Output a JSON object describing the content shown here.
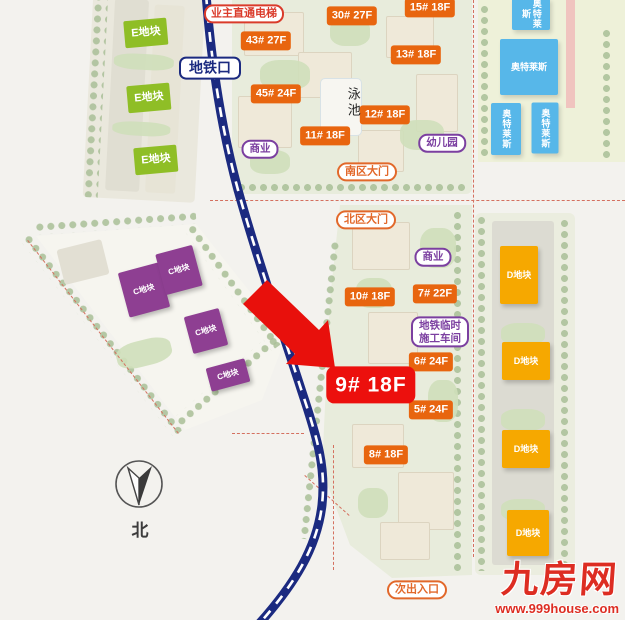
{
  "colors": {
    "building_label_orange": "#e8650f",
    "plot_e_green": "#8fbe26",
    "plot_c_purple": "#8e3f92",
    "plot_d_amber": "#f6a800",
    "commercial_blue": "#57b7e9",
    "highlight_red": "#ec100d",
    "metro_navy": "#1b2a80",
    "boundary_dash_red": "#d4705f",
    "watermark_red": "#dd2d22"
  },
  "watermark": {
    "brand": "九房网",
    "url": "www.999house.com"
  },
  "compass": {
    "label": "北"
  },
  "labels": [
    {
      "name": "building-label-15",
      "type": "t-orange",
      "text": "15# 18F",
      "x": 430,
      "y": 8
    },
    {
      "name": "building-label-30",
      "type": "t-orange",
      "text": "30# 27F",
      "x": 352,
      "y": 16
    },
    {
      "name": "building-label-43",
      "type": "t-orange",
      "text": "43# 27F",
      "x": 266,
      "y": 41
    },
    {
      "name": "building-label-13",
      "type": "t-orange",
      "text": "13# 18F",
      "x": 416,
      "y": 55
    },
    {
      "name": "building-label-45",
      "type": "t-orange",
      "text": "45# 24F",
      "x": 276,
      "y": 94
    },
    {
      "name": "building-label-12",
      "type": "t-orange",
      "text": "12# 18F",
      "x": 385,
      "y": 115
    },
    {
      "name": "building-label-11",
      "type": "t-orange",
      "text": "11# 18F",
      "x": 325,
      "y": 136
    },
    {
      "name": "building-label-10",
      "type": "t-orange",
      "text": "10# 18F",
      "x": 370,
      "y": 297
    },
    {
      "name": "building-label-7",
      "type": "t-orange",
      "text": "7# 22F",
      "x": 435,
      "y": 294
    },
    {
      "name": "building-label-6",
      "type": "t-orange",
      "text": "6# 24F",
      "x": 431,
      "y": 362
    },
    {
      "name": "building-label-5",
      "type": "t-orange",
      "text": "5# 24F",
      "x": 431,
      "y": 410
    },
    {
      "name": "building-label-8",
      "type": "t-orange",
      "text": "8# 18F",
      "x": 386,
      "y": 455
    },
    {
      "name": "plot-label-e-1",
      "type": "t-green",
      "text": "E地块",
      "x": 146,
      "y": 33,
      "rot": -5
    },
    {
      "name": "plot-label-e-2",
      "type": "t-green",
      "text": "E地块",
      "x": 149,
      "y": 98,
      "rot": -5
    },
    {
      "name": "plot-label-e-3",
      "type": "t-green",
      "text": "E地块",
      "x": 156,
      "y": 160,
      "rot": -5
    },
    {
      "name": "plot-label-c-1",
      "type": "t-cblock",
      "text": "C地块",
      "x": 144,
      "y": 290,
      "w": 42,
      "h": 46,
      "rot": -15
    },
    {
      "name": "plot-label-c-2",
      "type": "t-cblock",
      "text": "C地块",
      "x": 179,
      "y": 270,
      "w": 38,
      "h": 42,
      "rot": -15
    },
    {
      "name": "plot-label-c-3",
      "type": "t-cblock",
      "text": "C地块",
      "x": 206,
      "y": 331,
      "w": 36,
      "h": 38,
      "rot": -15
    },
    {
      "name": "plot-label-c-4",
      "type": "t-cblock",
      "text": "C地块",
      "x": 228,
      "y": 375,
      "w": 40,
      "h": 24,
      "rot": -15
    },
    {
      "name": "plot-label-d-1",
      "type": "t-dblock",
      "text": "D地块",
      "x": 519,
      "y": 275,
      "w": 38,
      "h": 58
    },
    {
      "name": "plot-label-d-2",
      "type": "t-dblock",
      "text": "D地块",
      "x": 526,
      "y": 361,
      "w": 48,
      "h": 38
    },
    {
      "name": "plot-label-d-3",
      "type": "t-dblock",
      "text": "D地块",
      "x": 526,
      "y": 449,
      "w": 48,
      "h": 38
    },
    {
      "name": "plot-label-d-4",
      "type": "t-dblock",
      "text": "D地块",
      "x": 528,
      "y": 533,
      "w": 42,
      "h": 46
    },
    {
      "name": "outlets-building-1",
      "type": "t-blue vert",
      "text": "奥特莱斯",
      "x": 531,
      "y": 14,
      "w": 38,
      "h": 32
    },
    {
      "name": "outlets-building-2",
      "type": "t-blue",
      "text": "奥特莱斯",
      "x": 529,
      "y": 67,
      "w": 58,
      "h": 56
    },
    {
      "name": "outlets-building-3",
      "type": "t-blue vert",
      "text": "奥特莱斯",
      "x": 506,
      "y": 129,
      "w": 30,
      "h": 52
    },
    {
      "name": "outlets-building-4",
      "type": "t-blue vert",
      "text": "奥特莱斯",
      "x": 545,
      "y": 128,
      "w": 27,
      "h": 51
    },
    {
      "name": "elevator-label",
      "type": "t-oline-red",
      "text": "业主直通电梯",
      "x": 244,
      "y": 14
    },
    {
      "name": "metro-entrance-label",
      "type": "t-oline-navy",
      "text": "地铁口",
      "x": 210,
      "y": 68
    },
    {
      "name": "commercial-label-1",
      "type": "t-oline-purple",
      "text": "商业",
      "x": 260,
      "y": 149
    },
    {
      "name": "kindergarten-label",
      "type": "t-oline-purple",
      "text": "幼儿园",
      "x": 442,
      "y": 143
    },
    {
      "name": "gate-label-south",
      "type": "t-oline-orange",
      "text": "南区大门",
      "x": 367,
      "y": 172
    },
    {
      "name": "gate-label-north",
      "type": "t-oline-orange",
      "text": "北区大门",
      "x": 366,
      "y": 220
    },
    {
      "name": "commercial-label-2",
      "type": "t-oline-purple",
      "text": "商业",
      "x": 433,
      "y": 257
    },
    {
      "name": "metro-workshop-label",
      "type": "t-oline-purple",
      "text": "地铁临时\n施工车间",
      "x": 440,
      "y": 332
    },
    {
      "name": "highlight-label-9",
      "type": "t-redbig",
      "text": "9# 18F",
      "x": 371,
      "y": 385
    },
    {
      "name": "secondary-entrance-label",
      "type": "t-oline-orange",
      "text": "次出入口",
      "x": 417,
      "y": 590
    },
    {
      "name": "pool-label",
      "type": "t-vtext",
      "text": "泳池",
      "x": 353,
      "y": 103
    }
  ]
}
